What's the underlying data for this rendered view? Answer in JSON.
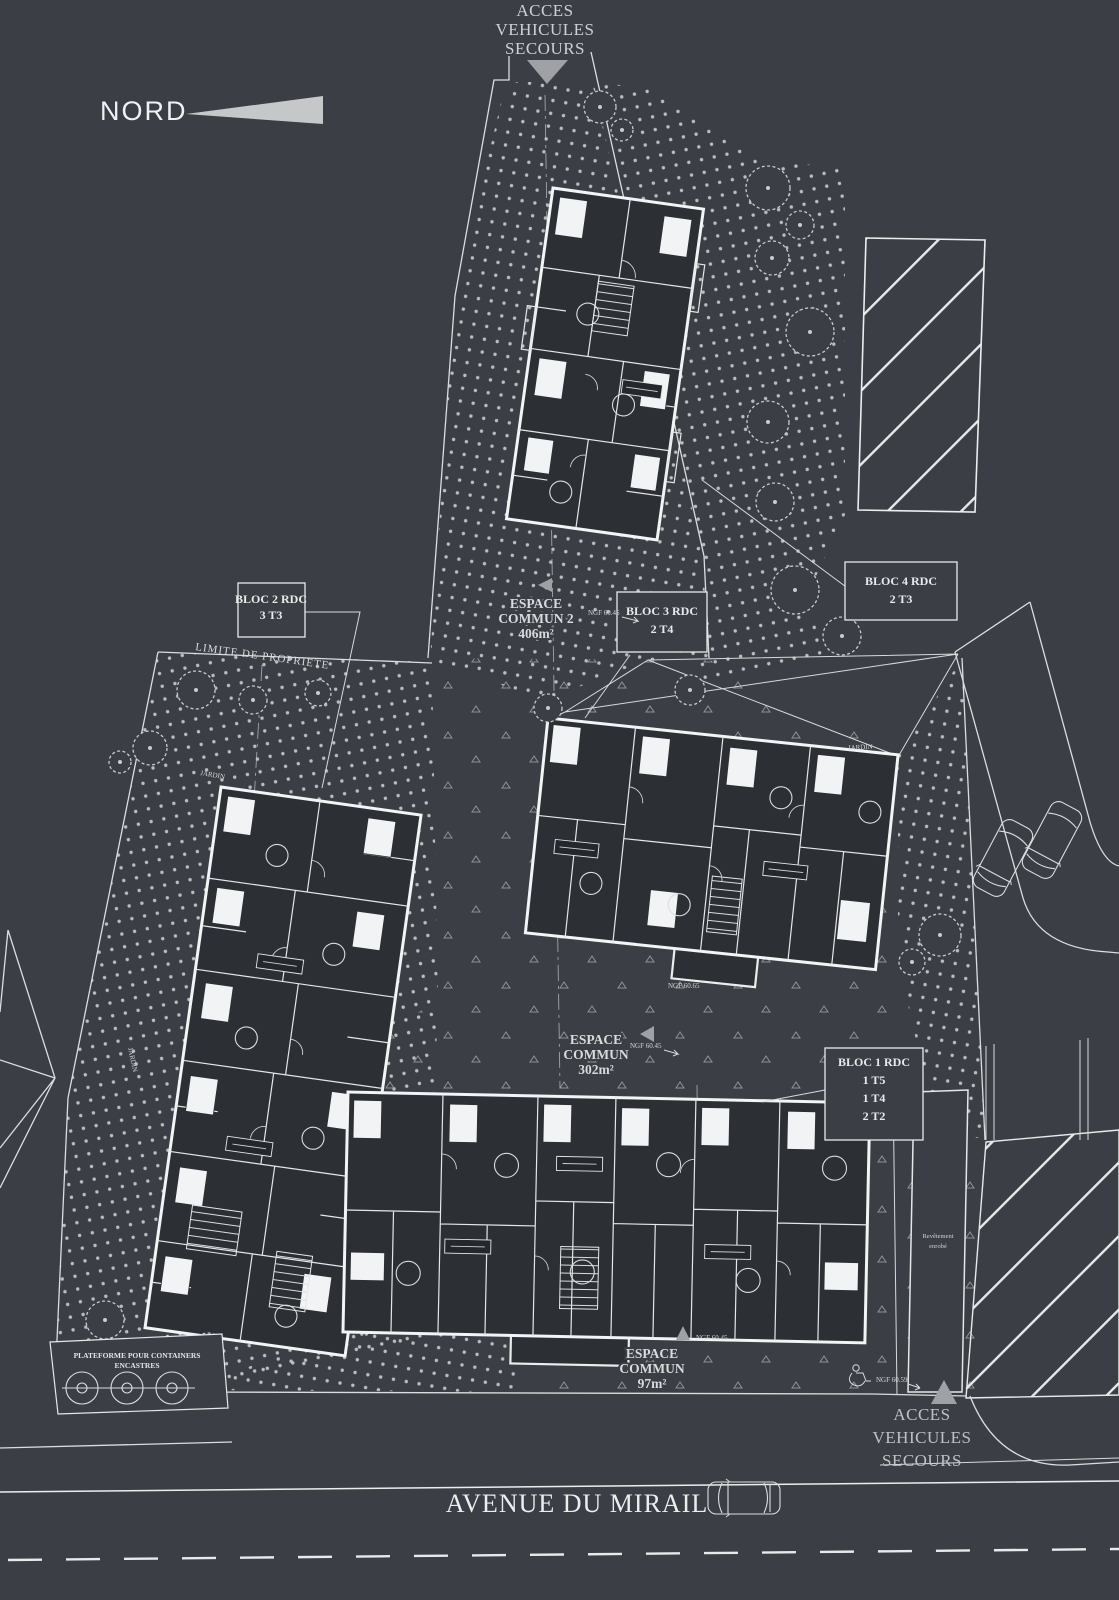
{
  "meta": {
    "background": "#3b3e44",
    "line_color": "#e8e9ea",
    "building_fill": "#2c2f34",
    "accent_gray": "#9fa1a4"
  },
  "compass": {
    "label": "NORD"
  },
  "access_top": {
    "line1": "ACCES",
    "line2": "VEHICULES",
    "line3": "SECOURS"
  },
  "access_bottom": {
    "line1": "ACCES",
    "line2": "VEHICULES",
    "line3": "SECOURS"
  },
  "street": {
    "name": "AVENUE DU MIRAIL"
  },
  "boundary": {
    "label": "LIMITE DE PROPRIETE"
  },
  "platform": {
    "line1": "PLATEFORME POUR CONTAINERS",
    "line2": "ENCASTRES"
  },
  "blocs": [
    {
      "id": "bloc1",
      "lines": [
        "BLOC 1 RDC",
        "1 T5",
        "1 T4",
        "2 T2"
      ]
    },
    {
      "id": "bloc2",
      "lines": [
        "BLOC 2 RDC",
        "3 T3"
      ]
    },
    {
      "id": "bloc3",
      "lines": [
        "BLOC 3 RDC",
        "2 T4"
      ]
    },
    {
      "id": "bloc4",
      "lines": [
        "BLOC 4 RDC",
        "2 T3"
      ]
    }
  ],
  "espaces": [
    {
      "lines": [
        "ESPACE",
        "COMMUN 2",
        "406m²"
      ]
    },
    {
      "lines": [
        "ESPACE",
        "COMMUN",
        "302m²"
      ]
    },
    {
      "lines": [
        "ESPACE",
        "COMMUN",
        "97m²"
      ]
    }
  ],
  "gardens": {
    "label": "JARDIN"
  },
  "levels": {
    "ngf_6045": "NGF 60.45",
    "ngf_6065": "NGF 60.65",
    "ngf_6059": "NGF 60.59"
  },
  "surface": {
    "line1": "Revêtement",
    "line2": "enrobé"
  }
}
